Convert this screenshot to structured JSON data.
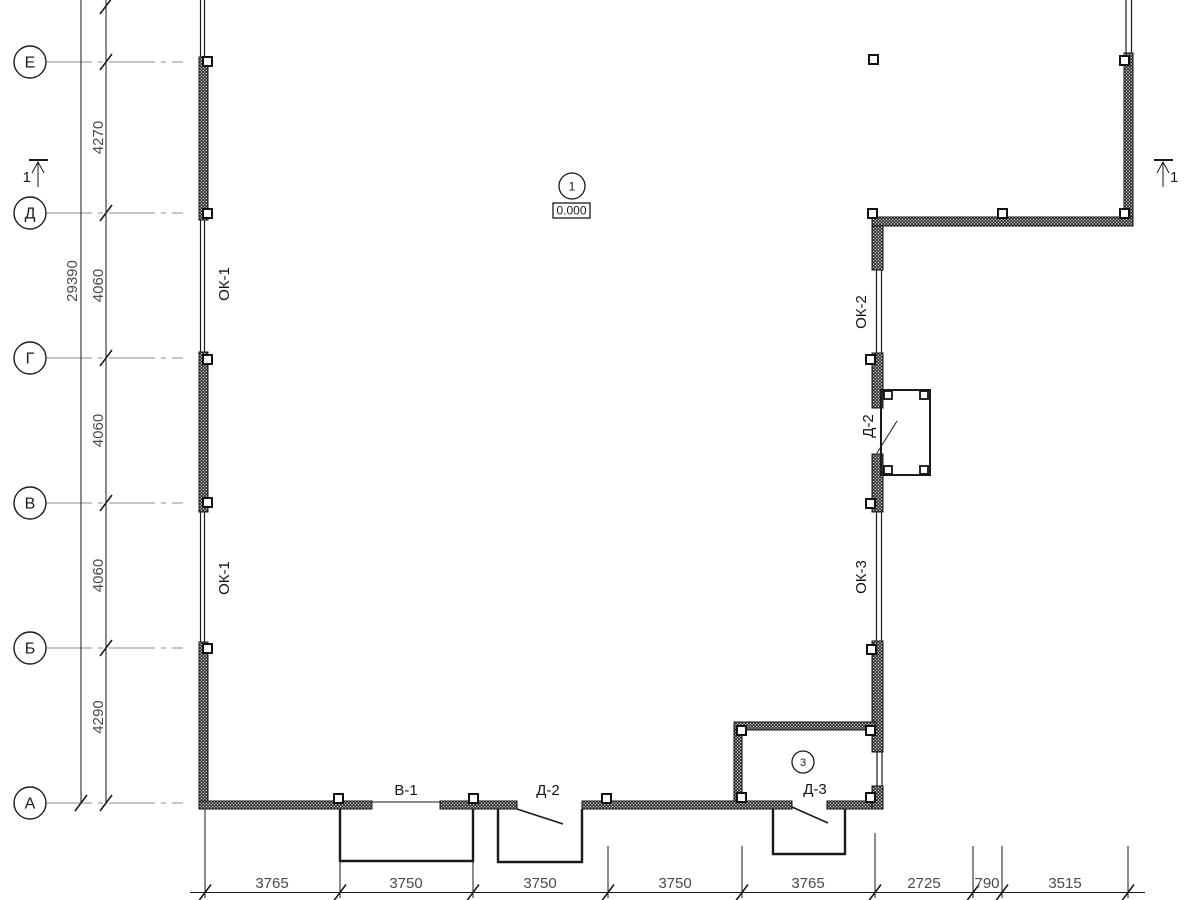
{
  "axes": [
    "Е",
    "Д",
    "Г",
    "В",
    "Б",
    "А"
  ],
  "vertical_dims": {
    "total": "29390",
    "segments": [
      "4270",
      "4060",
      "4060",
      "4060",
      "4290"
    ]
  },
  "bottom_dims": [
    "3765",
    "3750",
    "3750",
    "3750",
    "3765",
    "2725",
    "790",
    "3515"
  ],
  "opening_labels": {
    "ok1_upper": "ОК-1",
    "ok1_lower": "ОК-1",
    "ok2": "ОК-2",
    "ok3": "ОК-3",
    "d2_right_wall": "Д-2",
    "v1": "В-1",
    "d2_bottom_wall": "Д-2",
    "d3": "Д-3"
  },
  "room_tags": {
    "room1": "1",
    "room1_level": "0.000",
    "room3": "3"
  },
  "section_marks": {
    "left": "1",
    "right": "1"
  },
  "colors": {
    "line": "#1a1a1a",
    "axis_line": "#8c8c8c",
    "dim_text": "#4a4a4a",
    "wall_fill": "#111111",
    "background": "#ffffff"
  }
}
